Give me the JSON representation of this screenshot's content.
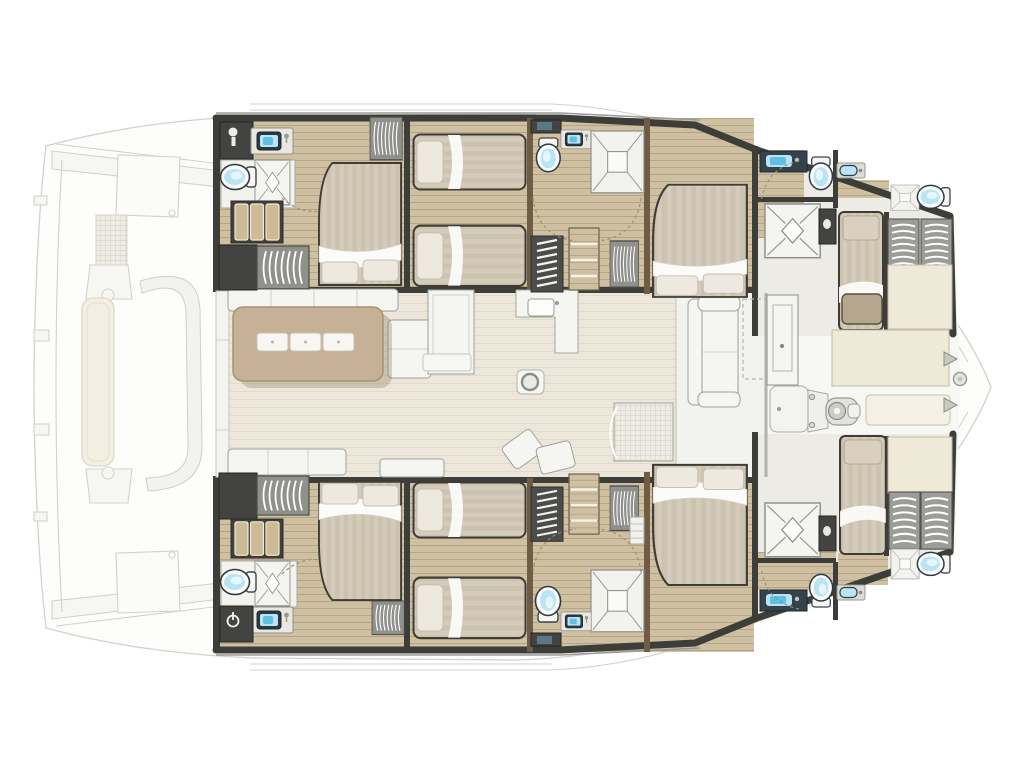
{
  "document": {
    "label": "Catamaran yacht floor plan — top-down cabin layout, bow pointing right",
    "type": "floor-plan"
  },
  "palette": {
    "bg": "#ffffff",
    "hull_fill": "#fdfdfc",
    "faded_fill": "#f6f6f3",
    "faded_stroke": "#d2d2cc",
    "wall_dark": "#3d3d3a",
    "wall_wood": "#6e5c44",
    "wood": "#cfc0a1",
    "wood_grain": "#b5a582",
    "salon_floor": "#ece7da",
    "salon_grain": "#ded7c4",
    "deck_white": "#f7f7f4",
    "furn_white": "#f5f5f2",
    "furn_stroke": "#a0a09a",
    "bath_floor": "#f2f2ef",
    "bath_line": "#a8a8a2",
    "fixture_blue": "#b9e4f4",
    "fixture_blue_deep": "#5fc0e2",
    "fixture_outline": "#2c3a44",
    "bed_duvet": "#d4cbbb",
    "bed_stripe": "#c8beac",
    "bed_fold": "#fbfbf9",
    "pillow": "#ede9df",
    "pillow_stroke": "#c6c0b2",
    "dark_cabinet": "#434341",
    "slat_gray": "#9c9c98",
    "table_tan": "#c7b196",
    "table_border": "#a8916f",
    "cream_pad": "#efe9d7",
    "cream_stroke": "#c2bca9",
    "grid_fill": "#eeece5",
    "grid_line": "#c8c5ba"
  },
  "legend": {
    "areas": [
      {
        "name": "aft-cockpit",
        "items": [
          "transom-walkway",
          "deck-locker",
          "helm-grid-panel",
          "sun-lounger",
          "curved-bench",
          "swim-steps"
        ]
      },
      {
        "name": "salon",
        "items": [
          "aft-sliding-door",
          "salon-sofa",
          "dining-table",
          "placemats",
          "tall-cabinet",
          "galley-counter",
          "galley-sink",
          "mast-post",
          "aft-bench",
          "chaise-cushions",
          "coffee-table",
          "technical-hatch",
          "vestibule-sofa",
          "roof-hatch",
          "forward-door"
        ]
      },
      {
        "name": "port-hull",
        "items": [
          "aft-cabin-double-bed",
          "aft-ensuite-toilet-sink-shower",
          "wardrobe-drawers",
          "hanging-lockers",
          "twin-cabin-two-beds",
          "mid-bathroom-toilet-sink-shower",
          "companionway-stairs",
          "shelf-unit",
          "forward-cabin-double-bed",
          "bow-cabin-single-berth",
          "bow-bathroom",
          "bow-wardrobes",
          "bow-bench"
        ]
      },
      {
        "name": "starboard-hull",
        "items": [
          "aft-cabin-double-bed",
          "aft-ensuite-toilet-sink-shower",
          "wardrobe-drawers",
          "hanging-lockers",
          "twin-cabin-two-beds",
          "mid-bathroom-toilet-sink-shower",
          "companionway-stairs",
          "shelf-unit",
          "forward-cabin-double-bed",
          "bow-cabin-single-berth",
          "bow-bathroom",
          "bow-wardrobes",
          "bow-bench"
        ]
      },
      {
        "name": "foredeck",
        "items": [
          "windlass",
          "deck-plate",
          "sun-pads",
          "bow-roller",
          "cleats"
        ]
      }
    ]
  },
  "summary": {
    "double_beds": 4,
    "twin_single_beds": 4,
    "bow_single_berths": 2,
    "toilets": 8,
    "showers": 8,
    "dining_tables": 1
  }
}
